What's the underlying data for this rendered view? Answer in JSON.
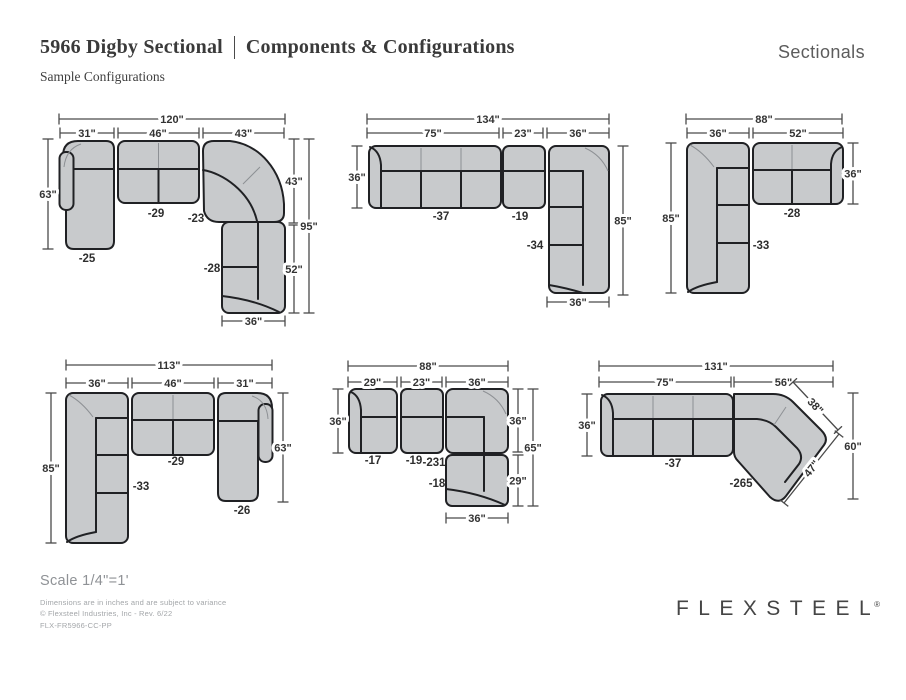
{
  "header": {
    "title_left": "5966 Digby Sectional",
    "title_right": "Components & Configurations",
    "category": "Sectionals",
    "subtitle": "Sample Configurations"
  },
  "footer": {
    "scale": "Scale 1/4\"=1'",
    "note1": "Dimensions are in inches and are subject to variance",
    "note2": "© Flexsteel Industries, Inc - Rev. 6/22",
    "note3": "FLX-FR5966-CC-PP",
    "logo": "FLEXSTEEL",
    "registered": "®"
  },
  "colors": {
    "piece_fill": "#c8cacc",
    "piece_outline": "#202124",
    "dimension_lines": "#4a4a4a",
    "title_text": "#3a3a3a",
    "muted_text": "#8f9296"
  },
  "configs": [
    {
      "pieces": [
        "-25",
        "-29",
        "-23",
        "-28"
      ],
      "dims": {
        "overall": "120\"",
        "seg0": "31\"",
        "seg1": "46\"",
        "seg2": "43\"",
        "left": "63\"",
        "right_upper": "43\"",
        "right_total": "95\"",
        "right_lower": "52\"",
        "bottom": "36\""
      }
    },
    {
      "pieces": [
        "-37",
        "-19",
        "-34"
      ],
      "dims": {
        "overall": "134\"",
        "seg0": "75\"",
        "seg1": "23\"",
        "seg2": "36\"",
        "left": "36\"",
        "right": "85\"",
        "bottom": "36\""
      }
    },
    {
      "pieces": [
        "-33",
        "-28"
      ],
      "dims": {
        "overall": "88\"",
        "seg0": "36\"",
        "seg1": "52\"",
        "left": "85\"",
        "right": "36\""
      }
    },
    {
      "pieces": [
        "-33",
        "-29",
        "-26"
      ],
      "dims": {
        "overall": "113\"",
        "seg0": "36\"",
        "seg1": "46\"",
        "seg2": "31\"",
        "left": "85\"",
        "right": "63\""
      }
    },
    {
      "pieces": [
        "-17",
        "-19",
        "-231",
        "-18"
      ],
      "dims": {
        "overall": "88\"",
        "seg0": "29\"",
        "seg1": "23\"",
        "seg2": "36\"",
        "left": "36\"",
        "right_upper": "36\"",
        "right_lower": "29\"",
        "right_total": "65\"",
        "bottom": "36\""
      }
    },
    {
      "pieces": [
        "-37",
        "-265"
      ],
      "dims": {
        "overall": "131\"",
        "seg0": "75\"",
        "seg1": "56\"",
        "left": "36\"",
        "diag_upper": "38\"",
        "diag_lower": "47\"",
        "right": "60\""
      }
    }
  ]
}
